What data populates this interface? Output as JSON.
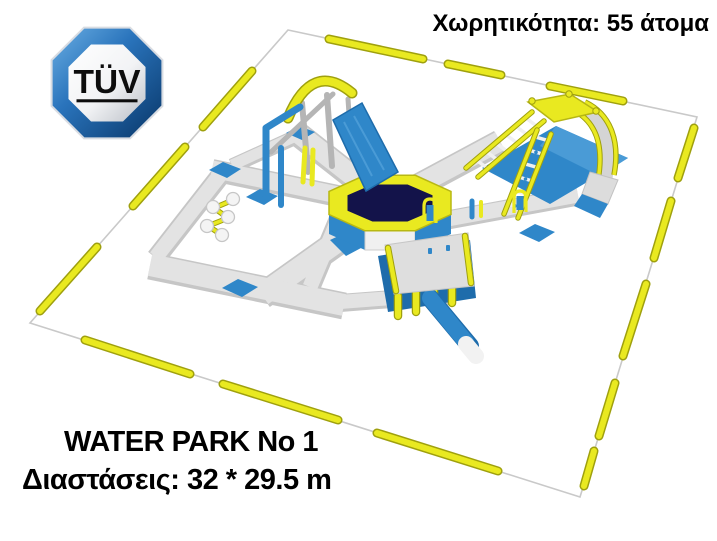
{
  "header": {
    "capacity_label": "Χωρητικότητα: 55 άτομα"
  },
  "footer": {
    "title": "WATER PARK No 1",
    "dimensions_label": "Διαστάσεις: 32 * 29.5 m"
  },
  "specs": {
    "capacity_people": 55,
    "width_m": 32,
    "length_m": 29.5
  },
  "logo": {
    "text": "TÜV"
  },
  "illustration": {
    "description": "Isometric 3D render of an inflatable floating water park enclosed by a yellow buoy perimeter line",
    "elements": [
      "perimeter-buoy-line",
      "walkway-ring",
      "walkway-arms",
      "octagon-trampoline",
      "swing-frame",
      "slide-tower",
      "hurdle-gates",
      "climbing-platform",
      "balance-spheres",
      "blue-pads",
      "slide-log"
    ]
  },
  "colors": {
    "background": "#ffffff",
    "text_black": "#000000",
    "buoy_yellow": "#e9e920",
    "buoy_yellow_dark": "#9fa00e",
    "inflatable_blue": "#2f87c9",
    "inflatable_blue_dark": "#1e6cab",
    "inflatable_blue_light": "#4a9bd6",
    "walkway_gray": "#c6c6c6",
    "walkway_top": "#e3e3e3",
    "trampoline_navy": "#13134a",
    "rope_gray": "#c9c9c9",
    "pole_gray": "#b5b5b5",
    "logo_blue_light": "#6cb0e4",
    "logo_blue": "#2a74bc",
    "logo_blue_dark": "#083668"
  }
}
